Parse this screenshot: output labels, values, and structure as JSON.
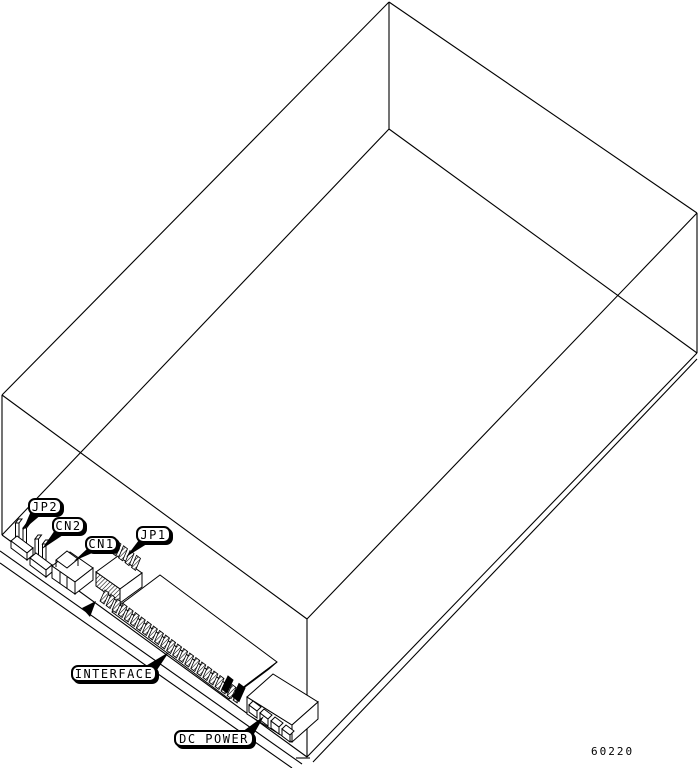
{
  "diagram": {
    "callouts": [
      {
        "id": "jp2",
        "label": "JP2"
      },
      {
        "id": "cn2",
        "label": "CN2"
      },
      {
        "id": "cn1",
        "label": "CN1"
      },
      {
        "id": "jp1",
        "label": "JP1"
      },
      {
        "id": "interface",
        "label": "INTERFACE"
      },
      {
        "id": "dc_power",
        "label": "DC POWER"
      }
    ],
    "figure_number": "60220",
    "colors": {
      "line": "#000000",
      "background": "#ffffff"
    }
  }
}
